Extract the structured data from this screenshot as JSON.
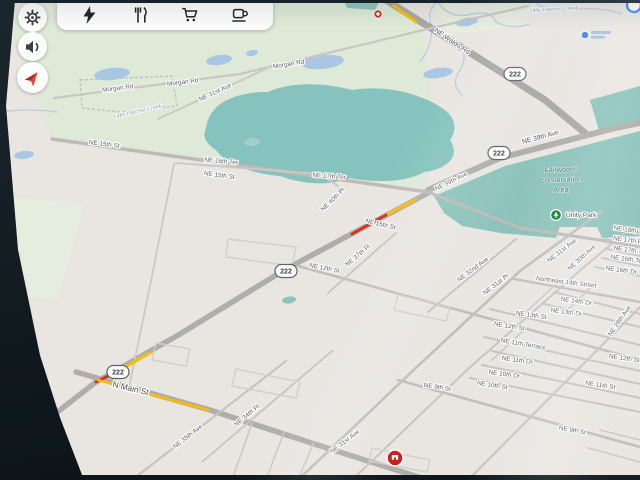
{
  "screen": {
    "type": "car navigation display",
    "accent": "#4285f4"
  },
  "toolbar": {
    "background": "#fdfdfc",
    "items": [
      {
        "icon": "ev-charging-icon"
      },
      {
        "icon": "restaurants-icon"
      },
      {
        "icon": "grocery-cart-icon"
      },
      {
        "icon": "coffee-icon"
      }
    ]
  },
  "side_buttons": [
    {
      "icon": "settings-gear-icon"
    },
    {
      "icon": "volume-icon"
    },
    {
      "icon": "navigation-arrow-icon",
      "color": "#e8453c"
    }
  ],
  "map": {
    "background": "#e9e6e2",
    "areas": [
      {
        "name": "parkland-northwest",
        "d": "M0,10 L398,0 L424,34 L431,100 L428,190 L52,138 Z",
        "fill": "#dfe9d8"
      },
      {
        "name": "parkland-top-right",
        "d": "M432,0 L540,0 L520,26 L448,36 Z",
        "fill": "#e7ecdf"
      },
      {
        "name": "parkland-west-strip",
        "d": "M0,196 L84,204 L58,300 L0,294 Z",
        "fill": "#e4edde"
      },
      {
        "name": "lake",
        "d": "M206,128 C210,100 240,92 268,92 C295,80 330,84 352,90 C390,84 424,96 442,108 C458,118 456,132 450,140 C462,158 444,170 424,172 C404,184 370,182 350,178 C324,188 296,182 280,176 C250,174 224,162 216,150 C204,142 203,136 206,128 Z",
        "fill": "#86c3be"
      },
      {
        "name": "conservation-area",
        "d": "M434,196 L505,166 L640,131 L640,236 L602,238 L597,227 L560,227 L556,238 L500,233 L462,226 L444,213 Z",
        "fill": "#8dc3bc"
      },
      {
        "name": "conservation-north-patch",
        "d": "M590,100 L640,86 L640,124 L600,134 Z",
        "fill": "#8dc3bc"
      },
      {
        "name": "teal-patch-top",
        "d": "M344,0 L380,0 L375,10 L347,8 Z",
        "fill": "#8dc3bc"
      }
    ],
    "ponds": [
      {
        "cx": 112,
        "cy": 74,
        "rx": 18,
        "ry": 6,
        "rot": -6,
        "fill": "#a9c7e4"
      },
      {
        "cx": 219,
        "cy": 60,
        "rx": 13,
        "ry": 5,
        "rot": -8,
        "fill": "#a9c7e4"
      },
      {
        "cx": 252,
        "cy": 53,
        "rx": 6,
        "ry": 3,
        "rot": -8,
        "fill": "#a9c7e4"
      },
      {
        "cx": 323,
        "cy": 62,
        "rx": 21,
        "ry": 7,
        "rot": -6,
        "fill": "#a9c7e4"
      },
      {
        "cx": 438,
        "cy": 73,
        "rx": 15,
        "ry": 5,
        "rot": -8,
        "fill": "#a9c7e4"
      },
      {
        "cx": 467,
        "cy": 22,
        "rx": 11,
        "ry": 4,
        "rot": -10,
        "fill": "#a9c7e4"
      },
      {
        "cx": 24,
        "cy": 155,
        "rx": 10,
        "ry": 4,
        "rot": -6,
        "fill": "#a9c7e4"
      },
      {
        "cx": 252,
        "cy": 142,
        "rx": 8,
        "ry": 4,
        "rot": -6,
        "fill": "#9ecfca"
      },
      {
        "cx": 289,
        "cy": 300,
        "rx": 7,
        "ry": 3.5,
        "rot": -8,
        "fill": "#8dc3bc"
      }
    ],
    "boundaries": [
      {
        "name": "park-boundary",
        "d": "M80,80 L172,76 L177,106 L120,112 L82,108 Z"
      }
    ],
    "creeks": [
      {
        "d": "M420,62 Q436,40 430,20 Q428,8 438,2"
      },
      {
        "d": "M438,2 Q450,20 472,14 Q492,10 496,22 Q512,30 530,24"
      },
      {
        "d": "M533,0 Q548,14 572,10 Q600,6 622,14"
      },
      {
        "d": "M456,40 Q470,55 460,70 Q450,84 462,95"
      },
      {
        "d": "M0,112 Q30,108 58,112"
      }
    ],
    "roads": [
      {
        "name": "NE Waldo Rd",
        "d": "M386,0 L450,40 L545,100 L585,133",
        "w": 7,
        "c": "#aaa8a5"
      },
      {
        "name": "NE 39th Ave",
        "d": "M428,190 L500,158 L615,128 L640,123",
        "w": 6,
        "c": "#b0aeab"
      },
      {
        "name": "SR 222 diagonal",
        "d": "M428,193 L286,269 L180,334 L96,382 L42,424",
        "w": 5.5,
        "c": "#b0aeab"
      },
      {
        "name": "N Main St",
        "d": "M76,372 L210,410 L330,449 L428,480",
        "w": 5.5,
        "c": "#b0aeab"
      },
      {
        "name": "NE 15th St west",
        "d": "M52,139 L428,192",
        "w": 3.5,
        "c": "#bebbb7"
      },
      {
        "name": "NE 15th St east",
        "d": "M428,192 L520,228 L600,240 L640,248",
        "w": 3,
        "c": "#bebbb7"
      },
      {
        "name": "Morgan Rd",
        "d": "M54,98 L240,74 L432,28 L528,6",
        "w": 2.2,
        "c": "#c9c6c2"
      },
      {
        "name": "NE 31st Ave north",
        "d": "M158,119 L272,66",
        "w": 2,
        "c": "#ccc9c5"
      },
      {
        "name": "NE 16th Ter",
        "d": "M176,163 L320,174 L338,186",
        "w": 2,
        "c": "#ccc9c5"
      },
      {
        "name": "NE 12th St",
        "d": "M298,266 L640,360",
        "w": 2.6,
        "c": "#c2bfbb"
      },
      {
        "name": "NE 9th St",
        "d": "M398,380 L640,447",
        "w": 2.6,
        "c": "#c2bfbb"
      },
      {
        "name": "NE 10th St",
        "d": "M470,378 L640,412",
        "w": 2,
        "c": "#c7c4c0"
      },
      {
        "name": "NE 10th Dr",
        "d": "M482,365 L640,398",
        "w": 2,
        "c": "#c7c4c0"
      },
      {
        "name": "NE 11th Dr",
        "d": "M492,351 L640,384",
        "w": 2,
        "c": "#c7c4c0"
      },
      {
        "name": "NE 11th Terrace",
        "d": "M484,337 L640,371",
        "w": 2,
        "c": "#c7c4c0"
      },
      {
        "name": "NE 13th St",
        "d": "M490,309 L640,345",
        "w": 2,
        "c": "#c7c4c0"
      },
      {
        "name": "NE 13th Dr",
        "d": "M544,304 L640,327",
        "w": 2,
        "c": "#c7c4c0"
      },
      {
        "name": "NE 14th Dr",
        "d": "M554,292 L640,314",
        "w": 2,
        "c": "#c7c4c0"
      },
      {
        "name": "Northeast 14th Street",
        "d": "M514,279 L640,302",
        "w": 2.4,
        "c": "#c2bfbb"
      },
      {
        "name": "edge street",
        "d": "M612,229 L640,235",
        "w": 1.8,
        "c": "#c7c4c0"
      },
      {
        "name": "edge street",
        "d": "M605,239 L640,246",
        "w": 1.8,
        "c": "#c7c4c0"
      },
      {
        "name": "edge street",
        "d": "M607,249 L640,256",
        "w": 1.8,
        "c": "#c7c4c0"
      },
      {
        "name": "edge street",
        "d": "M602,258 L640,266",
        "w": 1.8,
        "c": "#c7c4c0"
      },
      {
        "name": "edge street",
        "d": "M595,267 L640,276",
        "w": 1.8,
        "c": "#c7c4c0"
      },
      {
        "name": "NE 31st Ave",
        "d": "M298,480 L420,364 L520,271 L602,211",
        "w": 2.6,
        "c": "#c2bfbb"
      },
      {
        "name": "NE 30th Ave",
        "d": "M352,480 L468,369 L584,267 L626,232",
        "w": 2,
        "c": "#c7c4c0"
      },
      {
        "name": "NE 28th Ave",
        "d": "M468,480 L640,307",
        "w": 2.2,
        "c": "#c7c4c0"
      },
      {
        "name": "NE 32nd Ave",
        "d": "M428,312 L516,239",
        "w": 1.8,
        "c": "#c7c4c0"
      },
      {
        "name": "NE 37th Pl",
        "d": "M328,293 L396,233",
        "w": 1.8,
        "c": "#c7c4c0"
      },
      {
        "name": "NE 35th Ave",
        "d": "M132,480 L286,361",
        "w": 2.2,
        "c": "#c7c4c0"
      },
      {
        "name": "NE 34th Pl",
        "d": "M202,462 L332,351",
        "w": 1.8,
        "c": "#c7c4c0"
      },
      {
        "name": "local road",
        "d": "M174,164 L150,286 L130,383",
        "w": 1.8,
        "c": "#ccc9c5"
      },
      {
        "name": "local road",
        "d": "M252,423 L232,480",
        "w": 1.6,
        "c": "#ccc9c5"
      },
      {
        "name": "local road",
        "d": "M284,432 L266,480",
        "w": 1.6,
        "c": "#ccc9c5"
      },
      {
        "name": "local road",
        "d": "M314,442 L298,480",
        "w": 1.6,
        "c": "#ccc9c5"
      },
      {
        "name": "local road",
        "d": "M556,284 L520,318",
        "w": 1.6,
        "c": "#ccc9c5"
      },
      {
        "name": "local road",
        "d": "M596,282 L566,312",
        "w": 1.6,
        "c": "#ccc9c5"
      },
      {
        "name": "local road",
        "d": "M523,331 L492,360",
        "w": 1.6,
        "c": "#ccc9c5"
      },
      {
        "name": "local road",
        "d": "M588,448 L640,462",
        "w": 1.6,
        "c": "#ccc9c5"
      },
      {
        "name": "local road",
        "d": "M600,430 L640,440",
        "w": 1.6,
        "c": "#ccc9c5"
      },
      {
        "name": "block outline",
        "d": "M228,239 L296,247 L292,266 L226,257 Z",
        "w": 1.4,
        "c": "#d2cfcb"
      },
      {
        "name": "block outline",
        "d": "M156,343 L190,349 L186,366 L152,360 Z",
        "w": 1.4,
        "c": "#d2cfcb"
      },
      {
        "name": "block outline",
        "d": "M398,295 L450,307 L446,321 L394,310 Z",
        "w": 1.4,
        "c": "#d2cfcb"
      },
      {
        "name": "block outline",
        "d": "M236,369 L300,382 L296,398 L232,386 Z",
        "w": 1.4,
        "c": "#d2cfcb"
      },
      {
        "name": "block outline",
        "d": "M372,448 L430,460 L427,472 L369,461 Z",
        "w": 1.4,
        "c": "#d2cfcb"
      }
    ],
    "traffic": [
      {
        "color": "#fbbc04",
        "d": "M394,6 L416,22",
        "w": 3
      },
      {
        "color": "#fbbc04",
        "d": "M386,215 L415,200",
        "w": 3
      },
      {
        "color": "#d93025",
        "d": "M352,234 L386,215",
        "w": 3
      },
      {
        "color": "#fbbc04",
        "d": "M150,353 L120,370",
        "w": 3
      },
      {
        "color": "#d93025",
        "d": "M120,370 L96,382",
        "w": 3
      },
      {
        "color": "#fbbc04",
        "d": "M98,380 L208,410",
        "w": 2.6
      }
    ],
    "shields": [
      {
        "text": "222",
        "x": 515,
        "y": 74
      },
      {
        "text": "222",
        "x": 499,
        "y": 153
      },
      {
        "text": "222",
        "x": 286,
        "y": 271
      },
      {
        "text": "222",
        "x": 118,
        "y": 372
      }
    ],
    "labels": [
      {
        "text": "Morgan Rd",
        "x": 118,
        "y": 90,
        "rot": -7,
        "kind": "street"
      },
      {
        "text": "Morgan Rd",
        "x": 183,
        "y": 84,
        "rot": -7,
        "kind": "street"
      },
      {
        "text": "Morgan Rd",
        "x": 289,
        "y": 66,
        "rot": -9,
        "kind": "street"
      },
      {
        "text": "NE 31st Ave",
        "x": 216,
        "y": 94,
        "rot": -25,
        "kind": "street"
      },
      {
        "text": "Little Hatchet Creek",
        "x": 138,
        "y": 113,
        "rot": -13,
        "kind": "creek"
      },
      {
        "text": "Little Hatchet Creek",
        "x": 554,
        "y": 11,
        "rot": -3,
        "kind": "creek"
      },
      {
        "text": "NE 15th St",
        "x": 104,
        "y": 146,
        "rot": 7,
        "kind": "street"
      },
      {
        "text": "NE 16th Ter",
        "x": 221,
        "y": 163,
        "rot": 5,
        "kind": "street"
      },
      {
        "text": "NE 15th St",
        "x": 219,
        "y": 177,
        "rot": 8,
        "kind": "street"
      },
      {
        "text": "NE 17th Ter",
        "x": 329,
        "y": 178,
        "rot": 4,
        "kind": "street"
      },
      {
        "text": "NE 40th Pl",
        "x": 334,
        "y": 201,
        "rot": -44,
        "kind": "street"
      },
      {
        "text": "NE 39th Ave",
        "x": 452,
        "y": 183,
        "rot": -26,
        "kind": "street"
      },
      {
        "text": "NE Waldo Rd",
        "x": 451,
        "y": 43,
        "rot": 34,
        "kind": "major"
      },
      {
        "text": "NE 39th Ave",
        "x": 541,
        "y": 139,
        "rot": -15,
        "kind": "major"
      },
      {
        "text": "NE 15th St",
        "x": 380,
        "y": 226,
        "rot": 13,
        "kind": "street"
      },
      {
        "text": "NE 12th St",
        "x": 324,
        "y": 270,
        "rot": 11,
        "kind": "street"
      },
      {
        "text": "NE 37th Pl",
        "x": 359,
        "y": 257,
        "rot": -40,
        "kind": "street"
      },
      {
        "text": "NE 32nd Ave",
        "x": 474,
        "y": 271,
        "rot": -37,
        "kind": "street"
      },
      {
        "text": "NE 31st Pl",
        "x": 497,
        "y": 286,
        "rot": -37,
        "kind": "street"
      },
      {
        "text": "Northeast 14th Street",
        "x": 566,
        "y": 284,
        "rot": 7,
        "kind": "street"
      },
      {
        "text": "NE 14th Dr",
        "x": 576,
        "y": 303,
        "rot": 8,
        "kind": "street"
      },
      {
        "text": "NE 13th Dr",
        "x": 566,
        "y": 314,
        "rot": 8,
        "kind": "street"
      },
      {
        "text": "NE 13th St",
        "x": 531,
        "y": 317,
        "rot": 8,
        "kind": "street"
      },
      {
        "text": "NE 12th St",
        "x": 509,
        "y": 328,
        "rot": 9,
        "kind": "street"
      },
      {
        "text": "NE 11th Terrace",
        "x": 523,
        "y": 346,
        "rot": 10,
        "kind": "street"
      },
      {
        "text": "NE 11th Dr",
        "x": 517,
        "y": 362,
        "rot": 8,
        "kind": "street"
      },
      {
        "text": "NE 10th Dr",
        "x": 504,
        "y": 376,
        "rot": 8,
        "kind": "street"
      },
      {
        "text": "NE 10th St",
        "x": 492,
        "y": 387,
        "rot": 9,
        "kind": "street"
      },
      {
        "text": "NE 9th St",
        "x": 437,
        "y": 389,
        "rot": 9,
        "kind": "street"
      },
      {
        "text": "NE 11th St",
        "x": 600,
        "y": 387,
        "rot": 9,
        "kind": "street"
      },
      {
        "text": "NE 12th St",
        "x": 624,
        "y": 360,
        "rot": 8,
        "kind": "street"
      },
      {
        "text": "NE 9th St",
        "x": 572,
        "y": 432,
        "rot": 10,
        "kind": "street"
      },
      {
        "text": "NE 31st Ave",
        "x": 563,
        "y": 252,
        "rot": -38,
        "kind": "street"
      },
      {
        "text": "NE 30th Ave",
        "x": 583,
        "y": 259,
        "rot": -42,
        "kind": "street"
      },
      {
        "text": "NE 28th Ave",
        "x": 621,
        "y": 322,
        "rot": -55,
        "kind": "street"
      },
      {
        "text": "NE 18th Ter",
        "x": 630,
        "y": 232,
        "rot": 8,
        "kind": "street"
      },
      {
        "text": "NE 17th Pl",
        "x": 628,
        "y": 242,
        "rot": 8,
        "kind": "street"
      },
      {
        "text": "NE 17th Ter",
        "x": 630,
        "y": 252,
        "rot": 8,
        "kind": "street"
      },
      {
        "text": "NE 16th Ter",
        "x": 627,
        "y": 261,
        "rot": 8,
        "kind": "street"
      },
      {
        "text": "NE 16th Dr",
        "x": 621,
        "y": 272,
        "rot": 8,
        "kind": "street"
      },
      {
        "text": "N Main St",
        "x": 130,
        "y": 391,
        "rot": 13,
        "kind": "main"
      },
      {
        "text": "NE 35th Ave",
        "x": 189,
        "y": 438,
        "rot": -38,
        "kind": "street"
      },
      {
        "text": "NE 34th Pl",
        "x": 248,
        "y": 417,
        "rot": -40,
        "kind": "street"
      },
      {
        "text": "NE 31st Ave",
        "x": 346,
        "y": 443,
        "rot": -37,
        "kind": "street"
      },
      {
        "text": "Fairwoods",
        "x": 561,
        "y": 172,
        "rot": -2,
        "kind": "cons"
      },
      {
        "text": "Conservation",
        "x": 561,
        "y": 182,
        "rot": -2,
        "kind": "cons"
      },
      {
        "text": "Area",
        "x": 561,
        "y": 192,
        "rot": -2,
        "kind": "cons"
      },
      {
        "text": "Unity Park",
        "x": 566,
        "y": 217,
        "rot": 0,
        "kind": "poi"
      }
    ],
    "markers": [
      {
        "type": "closure",
        "x": 378,
        "y": 14
      },
      {
        "type": "poi-red",
        "x": 395,
        "y": 458
      },
      {
        "type": "poi-blue",
        "x": 585,
        "y": 35
      },
      {
        "type": "compass",
        "x": 634,
        "y": 5
      },
      {
        "type": "park",
        "x": 556,
        "y": 215
      }
    ]
  }
}
